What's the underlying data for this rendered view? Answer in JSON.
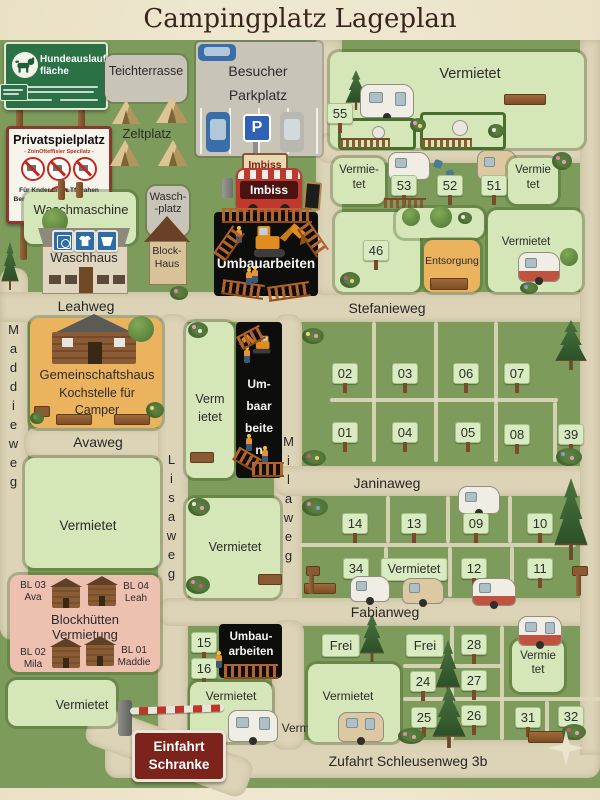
{
  "title": "Campingplatz Lageplan",
  "signs": {
    "dog": {
      "line1": "Hundeauslauf-",
      "line2": "fläche"
    },
    "playground": {
      "title": "Privatspielplatz",
      "subtitle": "- ZoinOfteffisier Specilatz -",
      "note1": "Für Knder unter Tflulahen",
      "note2": "Benossung auf sigene Felahr"
    },
    "entrance": {
      "line1": "Einfahrt",
      "line2": "Schranke"
    },
    "parking": "P"
  },
  "streets": {
    "leahweg": "Leahweg",
    "stefanieweg": "Stefanieweg",
    "maddieweg": "Maddieweg",
    "avaweg": "Avaweg",
    "lisaweg": "Lisaweg",
    "milaweg": "Milaweg",
    "janinaweg": "Janinaweg",
    "fabianweg": "Fabianweg",
    "zufahrt": "Zufahrt Schleusenweg 3b"
  },
  "areas": {
    "teich": "Teichterrasse",
    "besucher1": "Besucher",
    "besucher2": "Parkplatz",
    "zeltplatz": "Zeltplatz",
    "waschmaschine": "Waschmaschine",
    "waschplatz1": "Wasch-",
    "waschplatz2": "-platz",
    "waschhaus": "Waschhaus",
    "blockhaus1": "Block-",
    "blockhaus2": "Haus",
    "imbiss": "Imbiss",
    "umbau": "Umbauarbeiten",
    "umbau_m1": "Um-",
    "umbau_m2": "baar",
    "umbau_m3": "beite",
    "umbau_m4": "n",
    "umbau_b1": "Umbau-",
    "umbau_b2": "arbeiten",
    "entsorgung": "Entsorgung",
    "gemein1": "Gemeinschaftshaus",
    "gemein2": "Kochstelle für",
    "gemein3": "Camper",
    "block1": "Blockhütten",
    "block2": "Vermietung",
    "vermietet": "Vermietet",
    "verm": "Verm",
    "ietet": "ietet",
    "vermie_h": "Vermie-",
    "vermie": "Vermie",
    "tet": "tet",
    "frei": "Frei"
  },
  "cabins": {
    "bl03": "BL 03",
    "ava": "Ava",
    "bl04": "BL 04",
    "leah": "Leah",
    "bl02": "BL 02",
    "mila": "Mila",
    "bl01": "BL 01",
    "maddie": "Maddie"
  },
  "tags": {
    "t55": "55",
    "t53": "53",
    "t52": "52",
    "t51": "51",
    "t46": "46",
    "t02": "02",
    "t03": "03",
    "t06": "06",
    "t07": "07",
    "t01": "01",
    "t04": "04",
    "t05": "05",
    "t08": "08",
    "t39": "39",
    "t14": "14",
    "t13": "13",
    "t09": "09",
    "t10": "10",
    "t34": "34",
    "t12": "12",
    "t11": "11",
    "t15": "15",
    "t16": "16",
    "t28": "28",
    "t24": "24",
    "t27": "27",
    "t25": "25",
    "t26": "26",
    "t31": "31",
    "t32": "32"
  },
  "colors": {
    "plot_green": "#d5e6b8",
    "plot_orange": "#ecb35f",
    "plot_pink": "#eec0b0",
    "sign_green": "#2a7145",
    "sign_red": "#7c231c",
    "road": "#ddd4b8",
    "grass": "#7d9b5a",
    "construction": "#0d0d0c"
  }
}
